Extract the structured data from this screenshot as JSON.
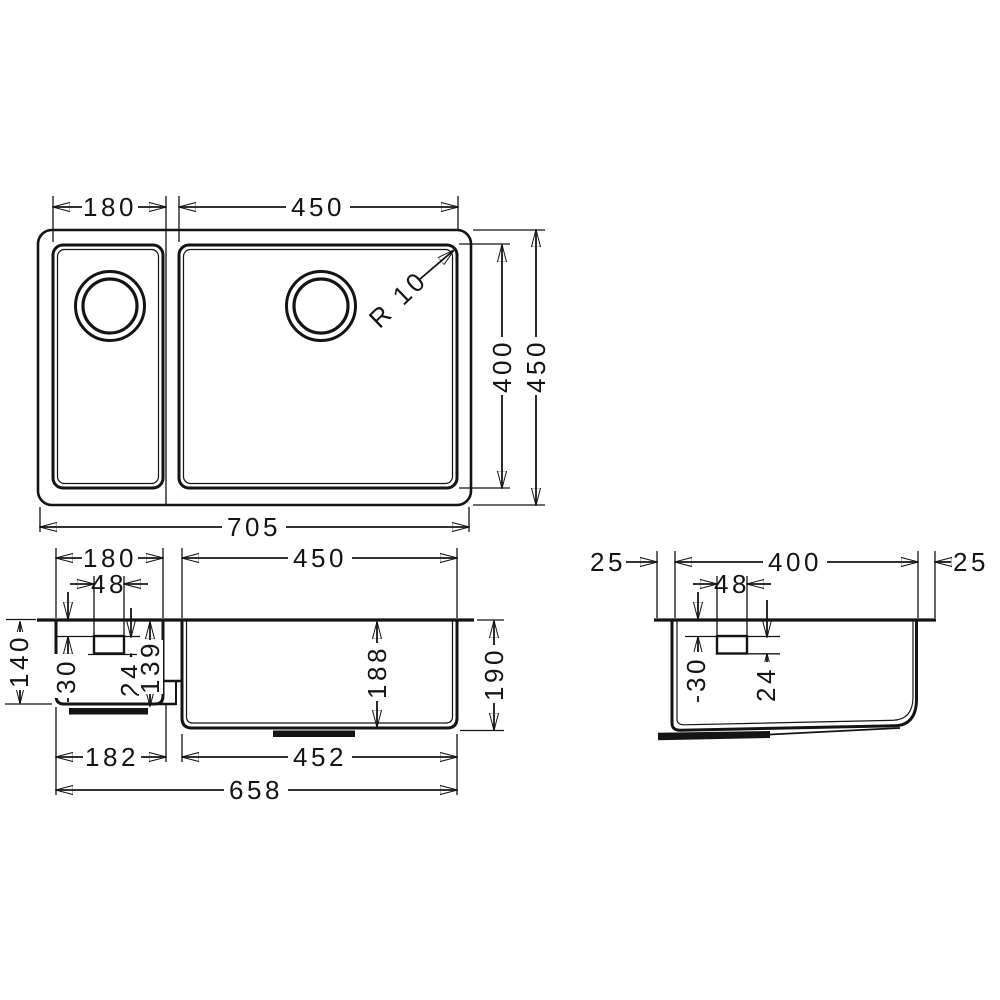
{
  "drawing": {
    "title": "Double-bowl undermount sink dimensional drawing",
    "units": "mm",
    "line_color": "#141414",
    "background_color": "#ffffff",
    "views": {
      "top": {
        "name": "top view",
        "dims": {
          "small_bowl_width": "180",
          "large_bowl_width": "450",
          "corner_radius": "R 10",
          "large_bowl_depth": "400",
          "overall_depth": "450",
          "overall_width": "705"
        }
      },
      "front": {
        "name": "front view",
        "dims": {
          "small_bowl_width": "180",
          "large_bowl_width": "450",
          "drain_width": "48",
          "small_bowl_height": "140",
          "drain_top_offset": "30",
          "drain_height": "24",
          "small_bowl_inner_depth": "139",
          "large_bowl_inner_depth": "188",
          "large_bowl_height": "190",
          "small_bowl_base_width": "182",
          "large_bowl_base_width": "452",
          "overall_base_width": "658"
        }
      },
      "side": {
        "name": "side view",
        "dims": {
          "left_overhang": "25",
          "bowl_depth": "400",
          "right_overhang": "25",
          "drain_width": "48",
          "drain_top_offset": "30",
          "drain_height": "24"
        }
      }
    }
  }
}
